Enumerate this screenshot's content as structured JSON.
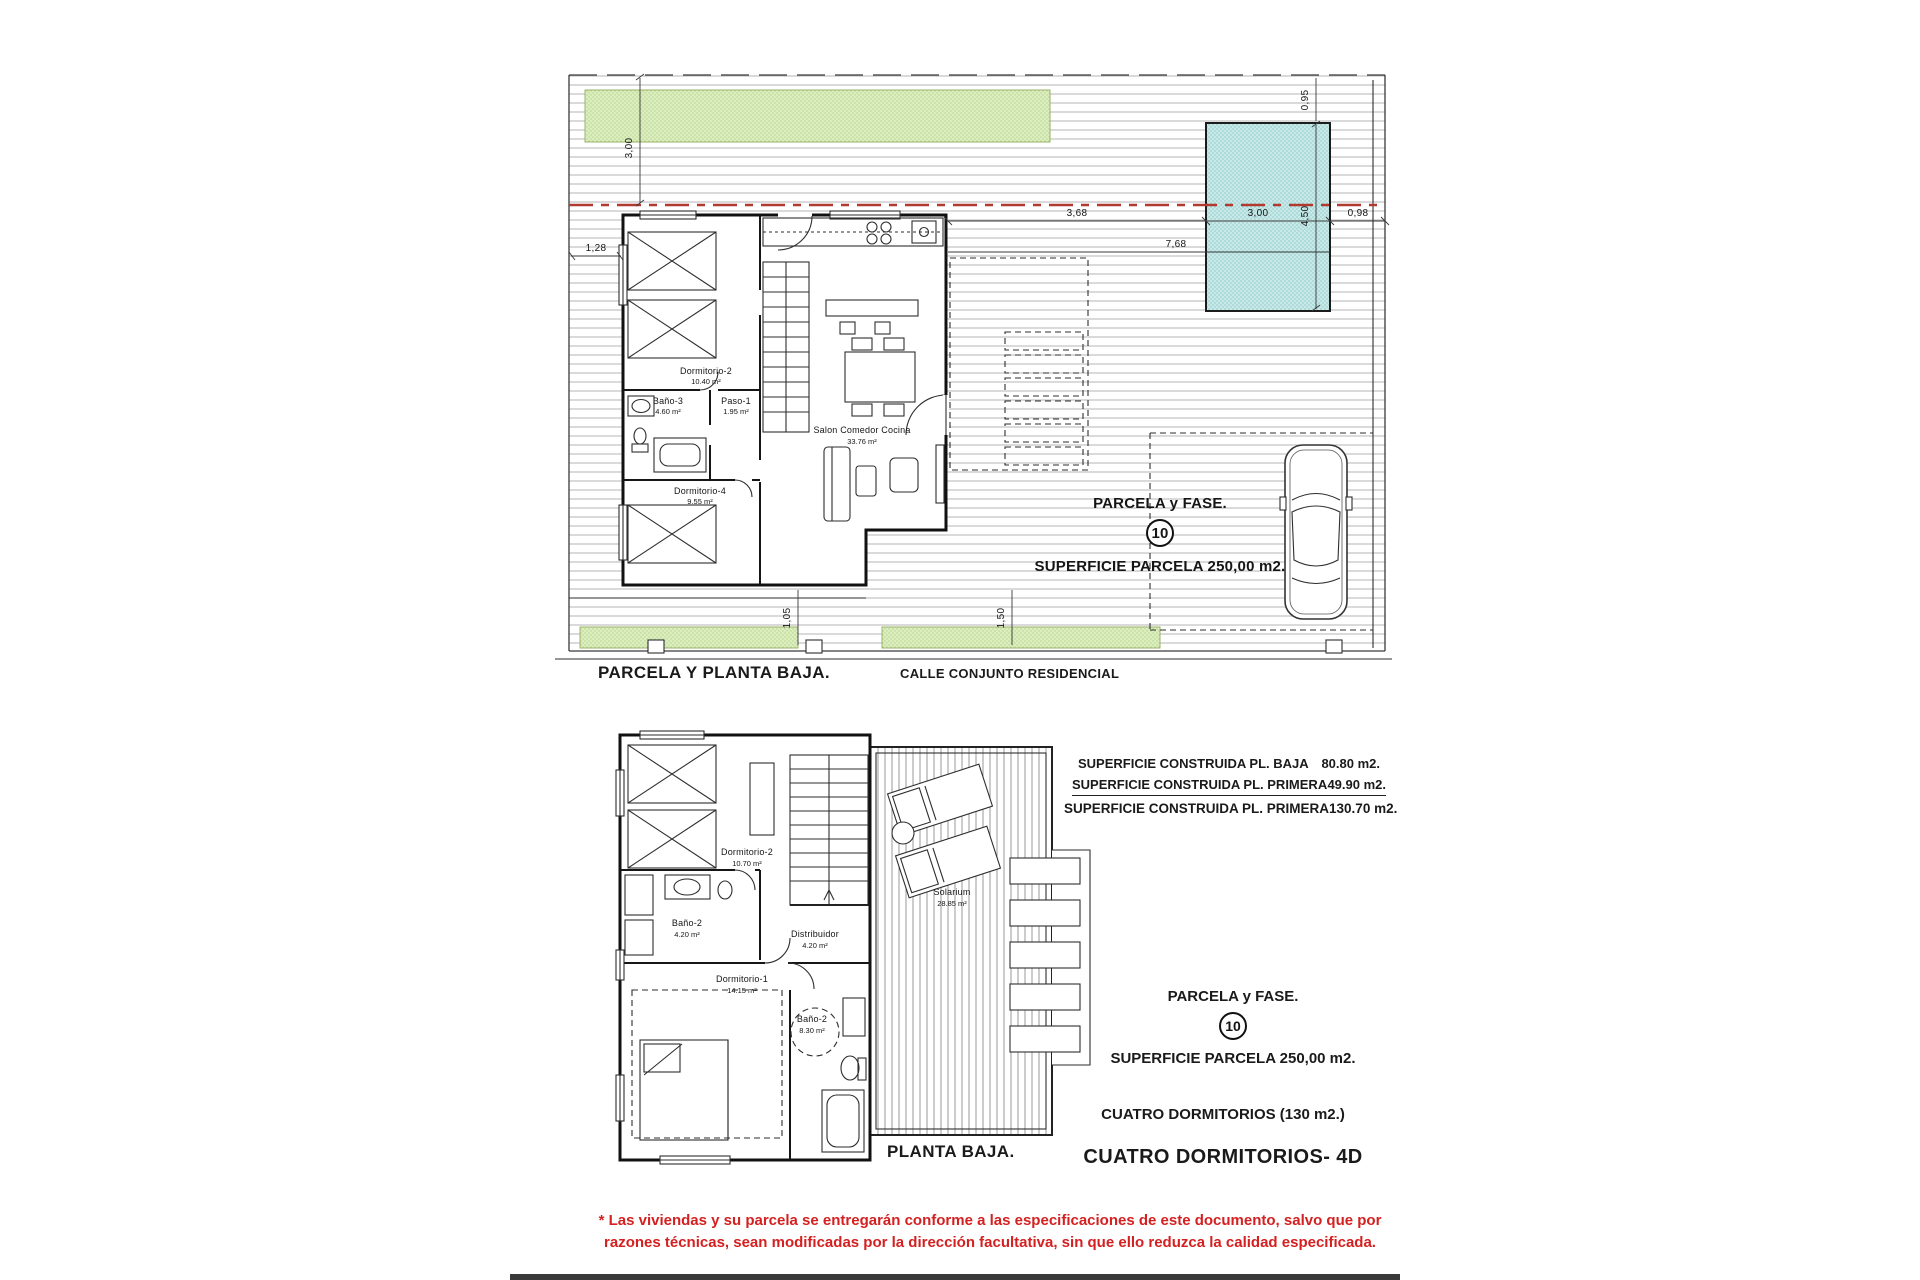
{
  "colors": {
    "green_area": "#dcedbf",
    "green_edge": "#9bb36b",
    "pool_fill": "#c8e9e7",
    "red_line": "#b03a30",
    "disclaimer_red": "#d42020",
    "bottom_bar": "#3a3a3a"
  },
  "top_plan": {
    "title": "PARCELA Y PLANTA BAJA.",
    "street_label": "CALLE CONJUNTO RESIDENCIAL",
    "parcel": {
      "label": "PARCELA y FASE.",
      "number": "10",
      "area": "SUPERFICIE PARCELA 250,00 m2."
    },
    "rooms": [
      {
        "name": "Dormitorio-2",
        "area": "10.40 m²"
      },
      {
        "name": "Baño-3",
        "area": "4.60 m²"
      },
      {
        "name": "Paso-1",
        "area": "1.95 m²"
      },
      {
        "name": "Dormitorio-4",
        "area": "9.55 m²"
      },
      {
        "name": "Salon Comedor Cocina",
        "area": "33.76 m²"
      }
    ],
    "dims": {
      "top_green": "3,00",
      "left_setback": "1,28",
      "pool_top": "0,95",
      "pool_left": "3,68",
      "pool_width": "3,00",
      "pool_right": "0,98",
      "pool_height": "4,50",
      "pool_total": "7,68",
      "bottom_left": "1,05",
      "bottom_right": "1,50"
    }
  },
  "bottom_plan": {
    "title": "PLANTA BAJA.",
    "rooms": [
      {
        "name": "Dormitorio-2",
        "area": "10.70 m²"
      },
      {
        "name": "Baño-2",
        "area": "4.20 m²"
      },
      {
        "name": "Distribuidor",
        "area": "4.20 m²"
      },
      {
        "name": "Dormitorio-1",
        "area": "14.15 m²"
      },
      {
        "name": "Baño-2",
        "area": "8.30 m²"
      },
      {
        "name": "Solarium",
        "area": "28.85 m²"
      }
    ]
  },
  "info_block": {
    "lines": [
      {
        "label": "SUPERFICIE CONSTRUIDA PL. BAJA",
        "value": "80.80 m2."
      },
      {
        "label": "SUPERFICIE CONSTRUIDA PL. PRIMERA",
        "value": "49.90 m2."
      },
      {
        "label": "SUPERFICIE CONSTRUIDA PL. PRIMERA",
        "value": "130.70  m2."
      }
    ]
  },
  "summary_block": {
    "parcel_label": "PARCELA y FASE.",
    "parcel_number": "10",
    "parcel_area": "SUPERFICIE PARCELA 250,00 m2.",
    "bedrooms": "CUATRO DORMITORIOS (130 m2.)",
    "model": "CUATRO DORMITORIOS- 4D"
  },
  "disclaimer": {
    "line1": "* Las viviendas y su parcela se entregarán conforme a las especificaciones de este documento, salvo que por",
    "line2": "razones técnicas, sean modificadas por la dirección facultativa, sin que ello reduzca la calidad especificada."
  }
}
